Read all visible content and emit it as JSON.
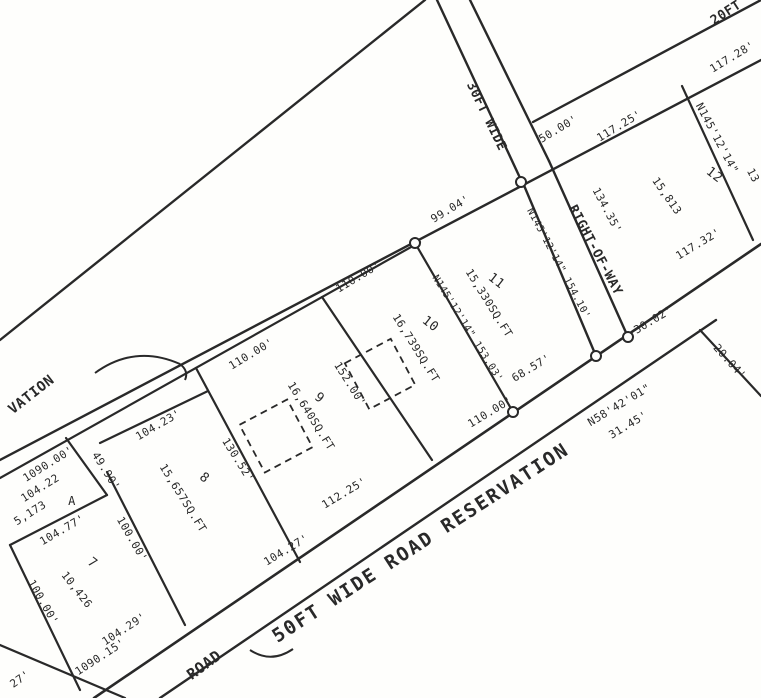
{
  "title": "Subdivision survey plat (scanned)",
  "colors": {
    "ink": "#2b2b2b",
    "paper": "#fcfcfa"
  },
  "lots": [
    {
      "number": "7",
      "area": "10,426"
    },
    {
      "number": "8",
      "area": "15,657SQ.FT"
    },
    {
      "number": "9",
      "area": "16,640SQ.FT"
    },
    {
      "number": "10",
      "area": "16,739SQ.FT"
    },
    {
      "number": "11",
      "area": "15,330SQ.FT"
    },
    {
      "number": "12",
      "area": "15,813"
    },
    {
      "number": "A",
      "area": "5,173"
    }
  ],
  "roads": [
    "20FT",
    "30FT WIDE RIGHT-OF-WAY",
    "50FT WIDE ROAD RESERVATION",
    "ROAD",
    "VATION"
  ],
  "plan": {
    "width": 761,
    "height": 698,
    "stroke": "#2b2b2b",
    "lines": [
      {
        "name": "upper-boundary-line",
        "x1": 425,
        "y1": 0,
        "x2": 0,
        "y2": 340,
        "w": 2.4
      },
      {
        "name": "frontage-inner-line",
        "x1": 0,
        "y1": 478,
        "x2": 420,
        "y2": 242,
        "w": 2.2
      },
      {
        "name": "frontage-outer-line",
        "x1": 0,
        "y1": 460,
        "x2": 761,
        "y2": 60,
        "w": 2.4
      },
      {
        "name": "road-reservation-upper-line",
        "x1": 94,
        "y1": 698,
        "x2": 761,
        "y2": 244,
        "w": 2.6
      },
      {
        "name": "road-reservation-lower-line",
        "x1": 160,
        "y1": 698,
        "x2": 716,
        "y2": 320,
        "w": 2.4
      },
      {
        "name": "bottom-left-road-line",
        "x1": 0,
        "y1": 645,
        "x2": 125,
        "y2": 698,
        "w": 2.2
      },
      {
        "name": "20ft-road-upper-line",
        "x1": 533,
        "y1": 122,
        "x2": 761,
        "y2": 0,
        "w": 2.4
      },
      {
        "name": "row-left-upper-line",
        "x1": 437,
        "y1": 0,
        "x2": 521,
        "y2": 180,
        "w": 2.4
      },
      {
        "name": "row-right-upper-line",
        "x1": 470,
        "y1": 0,
        "x2": 549,
        "y2": 161,
        "w": 2.4
      },
      {
        "name": "row-left-lower-line",
        "x1": 523,
        "y1": 183,
        "x2": 596,
        "y2": 356,
        "w": 2.4
      },
      {
        "name": "row-right-lower-line",
        "x1": 549,
        "y1": 161,
        "x2": 628,
        "y2": 337,
        "w": 2.4
      },
      {
        "name": "lot12-west-edge",
        "x1": 682,
        "y1": 86,
        "x2": 753,
        "y2": 240,
        "w": 2.2
      },
      {
        "name": "lot10-lot11-edge",
        "x1": 415,
        "y1": 243,
        "x2": 513,
        "y2": 412,
        "w": 2.2
      },
      {
        "name": "lot9-lot10-edge",
        "x1": 322,
        "y1": 297,
        "x2": 432,
        "y2": 460,
        "w": 2.2
      },
      {
        "name": "lot8-lot9-edge",
        "x1": 196,
        "y1": 368,
        "x2": 300,
        "y2": 562,
        "w": 2.2
      },
      {
        "name": "lot8-top-edge",
        "x1": 100,
        "y1": 443,
        "x2": 208,
        "y2": 391,
        "w": 2.2
      },
      {
        "name": "lot7-lot8-edge",
        "x1": 107,
        "y1": 472,
        "x2": 185,
        "y2": 625,
        "w": 2.2
      },
      {
        "name": "lot7-top-edge",
        "x1": 10,
        "y1": 545,
        "x2": 107,
        "y2": 495,
        "w": 2.2
      },
      {
        "name": "lotA-right-edge",
        "x1": 66,
        "y1": 438,
        "x2": 107,
        "y2": 495,
        "w": 2.2
      },
      {
        "name": "lot7-left-edge",
        "x1": 10,
        "y1": 545,
        "x2": 80,
        "y2": 690,
        "w": 2.2
      },
      {
        "name": "right-branch-line",
        "x1": 700,
        "y1": 330,
        "x2": 761,
        "y2": 396,
        "w": 2.2
      }
    ],
    "curves": [
      {
        "name": "reservation-arc",
        "d": "M95,373 Q135,344 180,364"
      },
      {
        "name": "arc-hook",
        "d": "M180,364 q9,7 5,16"
      },
      {
        "name": "road-junction-curve",
        "d": "M250,650 Q271,664 293,649"
      }
    ],
    "circles": [
      {
        "name": "monument-circle",
        "cx": 521,
        "cy": 182,
        "r": 5
      },
      {
        "name": "monument-circle",
        "cx": 415,
        "cy": 243,
        "r": 5
      },
      {
        "name": "monument-circle",
        "cx": 513,
        "cy": 412,
        "r": 5
      },
      {
        "name": "monument-circle",
        "cx": 596,
        "cy": 356,
        "r": 5
      },
      {
        "name": "monument-circle",
        "cx": 628,
        "cy": 337,
        "r": 5
      }
    ],
    "buildings": [
      {
        "name": "building-outline",
        "cx": 276,
        "cy": 436,
        "size": 54,
        "rot": -28
      },
      {
        "name": "building-outline",
        "cx": 380,
        "cy": 374,
        "size": 52,
        "rot": -28
      }
    ],
    "labels": [
      {
        "name": "label-20ft-road",
        "text": "20FT",
        "x": 728,
        "y": 16,
        "rot": -33,
        "size": 13,
        "bold": true
      },
      {
        "name": "dim-117-28",
        "text": "117.28'",
        "x": 734,
        "y": 60,
        "rot": -31,
        "size": 11
      },
      {
        "name": "bearing-lot12-west",
        "text": "N145'12'14\"",
        "x": 714,
        "y": 140,
        "rot": 62,
        "size": 11
      },
      {
        "name": "dim-lot12-west-partial",
        "text": "13",
        "x": 750,
        "y": 177,
        "rot": 62,
        "size": 11
      },
      {
        "name": "lot-number-12",
        "text": "12",
        "x": 712,
        "y": 178,
        "rot": 38,
        "size": 13
      },
      {
        "name": "lot-area-12",
        "text": "15,813",
        "x": 664,
        "y": 198,
        "rot": 55,
        "size": 11
      },
      {
        "name": "dim-117-32",
        "text": "117.32'",
        "x": 700,
        "y": 247,
        "rot": -31,
        "size": 11
      },
      {
        "name": "dim-50-00",
        "text": "50.00'",
        "x": 560,
        "y": 132,
        "rot": -31,
        "size": 11
      },
      {
        "name": "dim-117-25",
        "text": "117.25'",
        "x": 621,
        "y": 129,
        "rot": -31,
        "size": 11
      },
      {
        "name": "dim-134-35",
        "text": "134.35'",
        "x": 604,
        "y": 212,
        "rot": 62,
        "size": 11
      },
      {
        "name": "label-row-upper",
        "text": "30FT WIDE",
        "x": 483,
        "y": 118,
        "rot": 64,
        "size": 13,
        "bold": true
      },
      {
        "name": "label-row-lower",
        "text": "RIGHT-OF-WAY",
        "x": 592,
        "y": 252,
        "rot": 62,
        "size": 13,
        "bold": true
      },
      {
        "name": "bearing-lot11-east",
        "text": "N145'12'14\" 154.10'",
        "x": 556,
        "y": 265,
        "rot": 62,
        "size": 10
      },
      {
        "name": "dim-99-04",
        "text": "99.04'",
        "x": 452,
        "y": 212,
        "rot": -31,
        "size": 11
      },
      {
        "name": "lot-number-11",
        "text": "11",
        "x": 494,
        "y": 284,
        "rot": 38,
        "size": 13
      },
      {
        "name": "lot-area-11",
        "text": "15,330SQ.FT",
        "x": 486,
        "y": 305,
        "rot": 58,
        "size": 11
      },
      {
        "name": "bearing-lot11-west",
        "text": "N145'12'14\" 153.03'",
        "x": 465,
        "y": 330,
        "rot": 58,
        "size": 10
      },
      {
        "name": "dim-110-00-lot10-top",
        "text": "110.00'",
        "x": 360,
        "y": 280,
        "rot": -31,
        "size": 11
      },
      {
        "name": "lot-number-10",
        "text": "10",
        "x": 428,
        "y": 327,
        "rot": 38,
        "size": 13
      },
      {
        "name": "lot-area-10",
        "text": "16,739SQ.FT",
        "x": 413,
        "y": 350,
        "rot": 58,
        "size": 11
      },
      {
        "name": "dim-152-00",
        "text": "152.00'",
        "x": 347,
        "y": 386,
        "rot": 58,
        "size": 11
      },
      {
        "name": "dim-110-00-lot9-top",
        "text": "110.00'",
        "x": 253,
        "y": 357,
        "rot": -31,
        "size": 11
      },
      {
        "name": "lot-number-9",
        "text": "9",
        "x": 317,
        "y": 401,
        "rot": 38,
        "size": 13
      },
      {
        "name": "lot-area-9",
        "text": "16,640SQ.FT",
        "x": 308,
        "y": 418,
        "rot": 58,
        "size": 11
      },
      {
        "name": "dim-110-00-lot10-bottom",
        "text": "110.00'",
        "x": 492,
        "y": 415,
        "rot": -31,
        "size": 11
      },
      {
        "name": "dim-68-57",
        "text": "68.57'",
        "x": 533,
        "y": 371,
        "rot": -31,
        "size": 11
      },
      {
        "name": "dim-30-02",
        "text": "30.02'",
        "x": 655,
        "y": 323,
        "rot": -31,
        "size": 11
      },
      {
        "name": "dim-20-04",
        "text": "20.04'",
        "x": 727,
        "y": 364,
        "rot": 48,
        "size": 11
      },
      {
        "name": "bearing-road-reservation",
        "text": "N58'42'01\"",
        "x": 621,
        "y": 408,
        "rot": -31,
        "size": 11
      },
      {
        "name": "dim-31-45",
        "text": "31.45'",
        "x": 630,
        "y": 428,
        "rot": -31,
        "size": 11
      },
      {
        "name": "dim-104-23",
        "text": "104.23'",
        "x": 160,
        "y": 428,
        "rot": -30,
        "size": 11
      },
      {
        "name": "lot-number-8",
        "text": "8",
        "x": 202,
        "y": 481,
        "rot": 38,
        "size": 13
      },
      {
        "name": "lot-area-8",
        "text": "15,657SQ.FT",
        "x": 180,
        "y": 500,
        "rot": 58,
        "size": 11
      },
      {
        "name": "dim-130-52",
        "text": "130.52'",
        "x": 235,
        "y": 462,
        "rot": 58,
        "size": 11
      },
      {
        "name": "dim-104-27",
        "text": "104.27'",
        "x": 288,
        "y": 553,
        "rot": -31,
        "size": 11
      },
      {
        "name": "dim-112-25",
        "text": "112.25'",
        "x": 346,
        "y": 496,
        "rot": -31,
        "size": 11
      },
      {
        "name": "dim-1090-15",
        "text": "1090.15'",
        "x": 102,
        "y": 660,
        "rot": -33,
        "size": 11
      },
      {
        "name": "dim-104-29",
        "text": "104.29'",
        "x": 126,
        "y": 632,
        "rot": -33,
        "size": 11
      },
      {
        "name": "dim-27-partial",
        "text": "27'",
        "x": 22,
        "y": 682,
        "rot": -35,
        "size": 11
      },
      {
        "name": "label-road",
        "text": "ROAD",
        "x": 207,
        "y": 669,
        "rot": -36,
        "size": 15,
        "bold": true
      },
      {
        "name": "label-50ft-reservation",
        "text": "50FT WIDE ROAD RESERVATION",
        "x": 424,
        "y": 548,
        "rot": -33,
        "size": 19,
        "bold": true,
        "spacing": 2
      },
      {
        "name": "label-vation",
        "text": "VATION",
        "x": 34,
        "y": 398,
        "rot": -38,
        "size": 14,
        "bold": true
      },
      {
        "name": "dim-1090-00",
        "text": "1090.00'",
        "x": 50,
        "y": 467,
        "rot": -32,
        "size": 11
      },
      {
        "name": "dim-104-22",
        "text": "104.22",
        "x": 42,
        "y": 491,
        "rot": -32,
        "size": 11
      },
      {
        "name": "lot-area-a",
        "text": "5,173",
        "x": 32,
        "y": 516,
        "rot": -32,
        "size": 11
      },
      {
        "name": "lot-number-a",
        "text": "A",
        "x": 72,
        "y": 505,
        "rot": 0,
        "size": 12
      },
      {
        "name": "dim-49-90",
        "text": "49.90'",
        "x": 103,
        "y": 473,
        "rot": 58,
        "size": 11
      },
      {
        "name": "dim-104-77",
        "text": "104.77'",
        "x": 64,
        "y": 533,
        "rot": -30,
        "size": 11
      },
      {
        "name": "lot-number-7",
        "text": "7",
        "x": 90,
        "y": 566,
        "rot": 38,
        "size": 13
      },
      {
        "name": "lot-area-7",
        "text": "10,426",
        "x": 74,
        "y": 592,
        "rot": 52,
        "size": 11
      },
      {
        "name": "dim-100-00-lot7-left",
        "text": "100.00'",
        "x": 40,
        "y": 604,
        "rot": 60,
        "size": 11
      },
      {
        "name": "dim-100-00-lot7-right",
        "text": "100.00'",
        "x": 129,
        "y": 541,
        "rot": 60,
        "size": 11
      }
    ]
  }
}
